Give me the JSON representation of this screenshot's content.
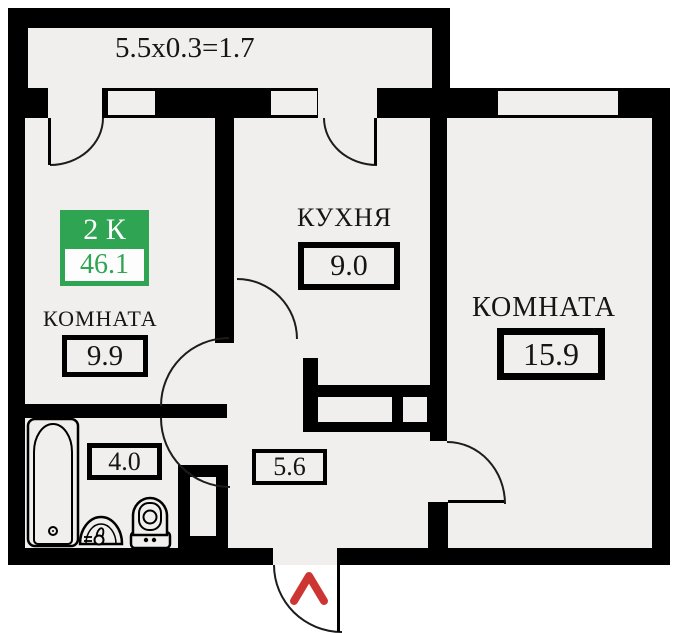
{
  "balcony": {
    "dimension": "5.5x0.3=1.7"
  },
  "badge": {
    "label": "2 К",
    "total_area": "46.1"
  },
  "rooms": {
    "room1": {
      "name": "КОМНАТА",
      "area": "9.9"
    },
    "kitchen": {
      "name": "КУХНЯ",
      "area": "9.0"
    },
    "room2": {
      "name": "КОМНАТА",
      "area": "15.9"
    },
    "bathroom": {
      "area": "4.0"
    },
    "hallway": {
      "area": "5.6"
    }
  },
  "icons": [
    "bathtub-icon",
    "sink-icon",
    "toilet-icon",
    "entrance-arrow-icon"
  ],
  "colors": {
    "badge_green": "#2FA452",
    "entrance_arrow_red": "#CD3533",
    "wall": "#000000",
    "floor": "#F0EFED"
  }
}
